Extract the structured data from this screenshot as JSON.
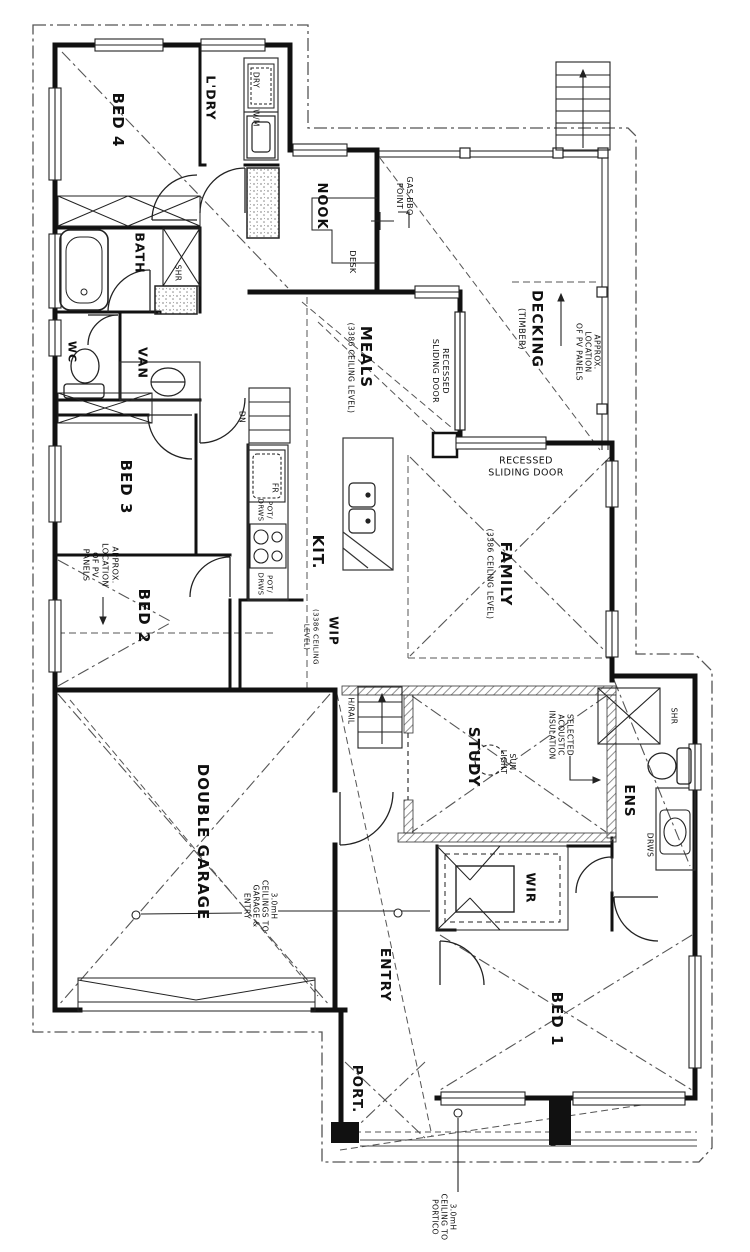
{
  "title": "house-floor-plan",
  "rooms": {
    "bed4": "BED 4",
    "ldry": "L'DRY",
    "dry": "DRY",
    "wm": "W/M",
    "bath": "BATH",
    "shr": "SHR",
    "wc": "WC",
    "van": "VAN",
    "bed3": "BED 3",
    "bed2": "BED 2",
    "nook": "NOOK",
    "desk": "DESK",
    "meals": "MEALS",
    "kit": "KIT.",
    "fr": "FR",
    "pot_drws": "POT/\nDRWS",
    "dn": "DN",
    "wip": "WIP",
    "family": "FAMILY",
    "decking": "DECKING",
    "decking_sub": "(TIMBER)",
    "ceiling_note": "(3386 CEILING LEVEL)",
    "wip_ceiling_note": "(3386 CEILING\nLEVEL)",
    "hrail": "H/RAIL",
    "study": "STUDY",
    "sun_light": "SUN\nLIGHT",
    "ens": "ENS",
    "drws": "DRWS",
    "wir": "WIR",
    "bed1": "BED 1",
    "garage": "DOUBLE GARAGE",
    "entry": "ENTRY",
    "port": "PORT."
  },
  "annotations": {
    "gas_bbq": "GAS BBQ\nPOINT",
    "pv_left": "APPROX.\nLOCATION\nOF PV\nPANELS",
    "pv_deck": "APPROX.\nLOCATION\nOF PV PANELS",
    "recessed_deck": "RECESSED\nSLIDING DOOR",
    "recessed_family": "RECESSED\nSLIDING DOOR",
    "acoustic": "SELECTED\nACOUSTIC\nINSULATION",
    "garage_ceiling": "3.0mH\nCEILINGS TO\nGARAGE &\nENTRY",
    "portico_ceiling": "3.0mH\nCEILING TO\nPORTICO"
  },
  "colors": {
    "wall": "#111111",
    "thin": "#333333",
    "roofline": "#444444",
    "hatch": "#666666"
  }
}
